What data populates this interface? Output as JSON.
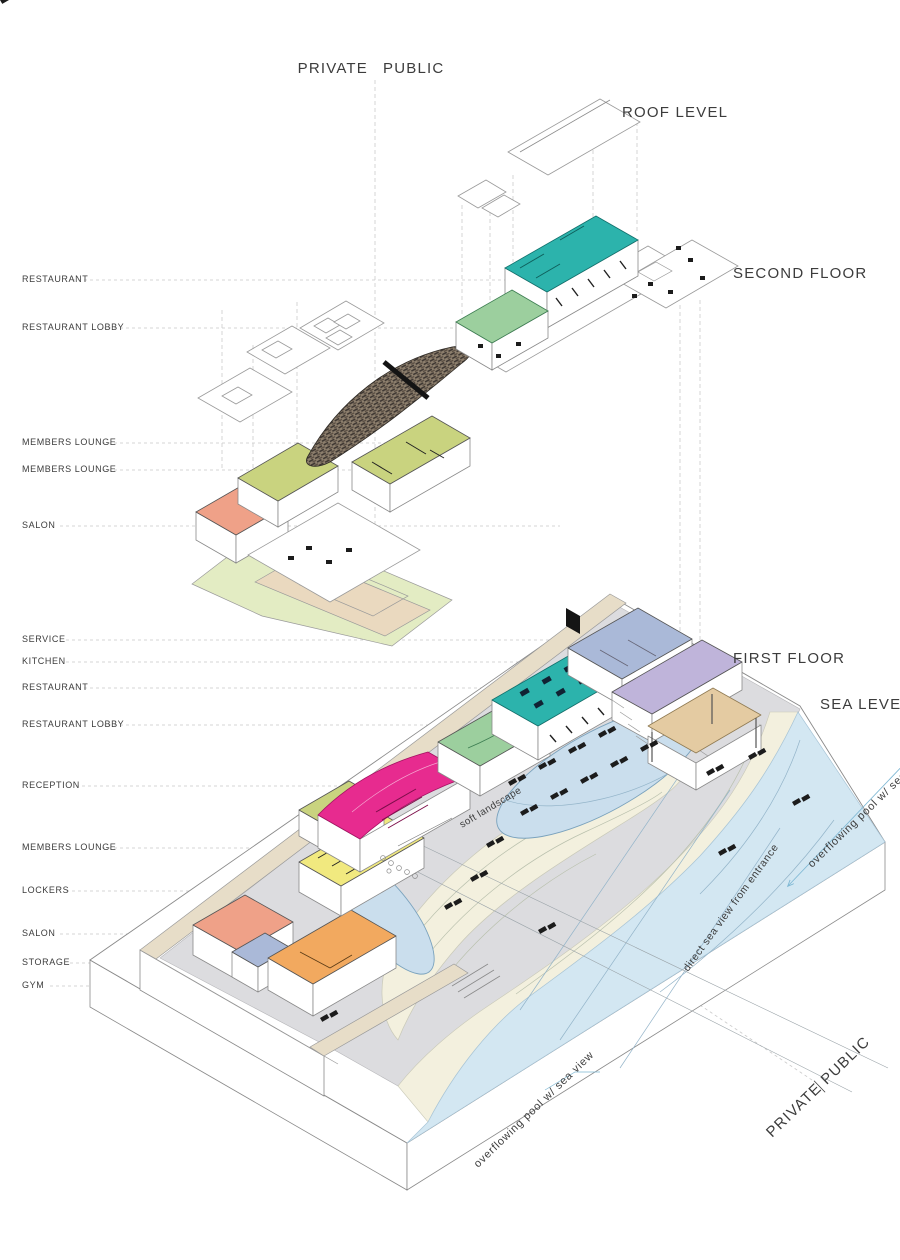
{
  "divider_top": {
    "left": "PRIVATE",
    "right": "PUBLIC"
  },
  "divider_bottom": {
    "left": "PRIVATE",
    "right": "PUBLIC"
  },
  "levels": {
    "roof": "ROOF LEVEL",
    "second": "SECOND FLOOR",
    "first": "FIRST FLOOR",
    "sea": "SEA LEVEL"
  },
  "left_labels": [
    {
      "text": "RESTAURANT"
    },
    {
      "text": "RESTAURANT LOBBY"
    },
    {
      "text": "MEMBERS LOUNGE"
    },
    {
      "text": "MEMBERS LOUNGE"
    },
    {
      "text": "SALON"
    },
    {
      "text": "SERVICE"
    },
    {
      "text": "KITCHEN"
    },
    {
      "text": "RESTAURANT"
    },
    {
      "text": "RESTAURANT LOBBY"
    },
    {
      "text": "RECEPTION"
    },
    {
      "text": "MEMBERS LOUNGE"
    },
    {
      "text": "LOCKERS"
    },
    {
      "text": "SALON"
    },
    {
      "text": "STORAGE"
    },
    {
      "text": "GYM"
    }
  ],
  "annotations": {
    "soft_landscape": "soft landscape",
    "direct_sea_view": "direct sea view from entrance",
    "overflow_pool_right": "overflowing pool w/ sea view",
    "overflow_pool_left": "overflowing pool w/ sea view"
  },
  "colors": {
    "teal": "#2cb3ac",
    "magenta": "#e72b8f",
    "yellow": "#f1e97f",
    "salmon": "#efa188",
    "orange": "#f2a95f",
    "olive": "#c9d37f",
    "green": "#9ccf9e",
    "periwinkle": "#aab9d8",
    "lavender": "#bfb4da",
    "tan_canopy": "#e4cba2",
    "pool": "#cadeed",
    "sea": "#d3e7f2",
    "sand": "#f3f0de",
    "deck": "#dcdcdf",
    "wall_beige": "#e7ddc8",
    "ground_green": "#e3ecc3",
    "path_beige": "#ead9bf",
    "annotation_blue": "#5fa8cc",
    "text_dark": "#3c3c3c"
  }
}
